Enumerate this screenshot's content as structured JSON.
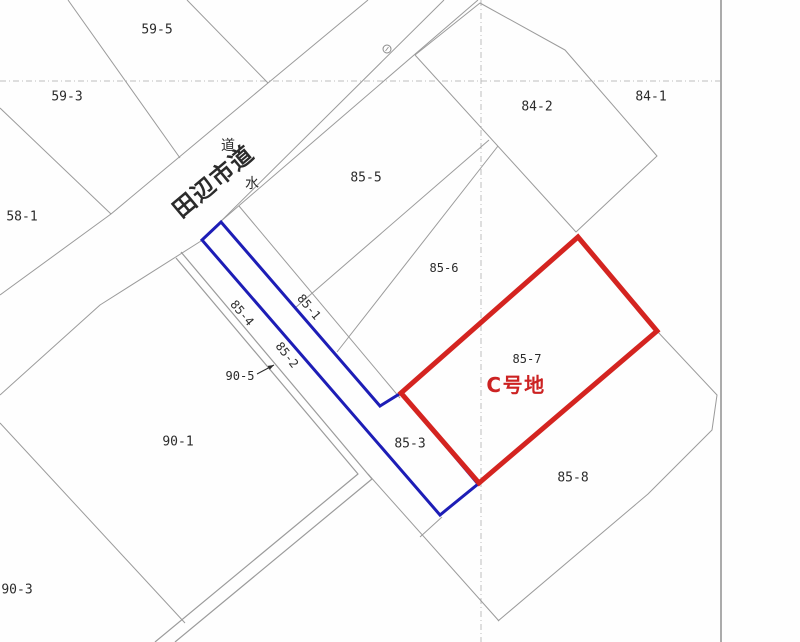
{
  "map": {
    "title_semantic": "cadastral-parcel-map",
    "width": 800,
    "height": 642,
    "colors": {
      "background": "#fefefe",
      "parcel_line": "#9b9b9b",
      "grid_dash_line": "#bdbdbd",
      "sheet_edge": "#ababab",
      "highlight_blue": "#1d1db6",
      "highlight_red": "#d42420",
      "label_text": "#2b2b2b",
      "red_label_text": "#cc2222",
      "symbol_gray": "#8a8a8a"
    },
    "grid_dash_lines": [
      {
        "name": "grid-line-horizontal",
        "pts": [
          [
            0,
            81
          ],
          [
            721,
            81
          ]
        ]
      },
      {
        "name": "grid-line-vertical",
        "pts": [
          [
            481,
            0
          ],
          [
            481,
            642
          ]
        ]
      }
    ],
    "sheet_edge_line": {
      "name": "sheet-edge",
      "pts": [
        [
          721,
          0
        ],
        [
          721,
          642
        ]
      ]
    },
    "parcel_lines": [
      {
        "name": "boundary-59-5-west",
        "pts": [
          [
            68,
            0
          ],
          [
            180,
            158
          ]
        ]
      },
      {
        "name": "boundary-59-5-east",
        "pts": [
          [
            187,
            0
          ],
          [
            268,
            83
          ]
        ]
      },
      {
        "name": "road-northwest-edge",
        "pts": [
          [
            368,
            0
          ],
          [
            268,
            83
          ],
          [
            111,
            214
          ],
          [
            0,
            295
          ]
        ]
      },
      {
        "name": "road-southeast-edge",
        "pts": [
          [
            444,
            0
          ],
          [
            201,
            241
          ],
          [
            100,
            305
          ],
          [
            0,
            395
          ]
        ]
      },
      {
        "name": "water-strip-east-edge",
        "pts": [
          [
            478,
            0
          ],
          [
            220,
            222
          ]
        ]
      },
      {
        "name": "boundary-59-3-southwest",
        "pts": [
          [
            0,
            108
          ],
          [
            111,
            214
          ]
        ]
      },
      {
        "name": "boundary-90-1-northwest",
        "pts": [
          [
            0,
            423
          ],
          [
            185,
            623
          ]
        ]
      },
      {
        "name": "parcel-84-2-outline",
        "pts": [
          [
            415,
            55
          ],
          [
            480,
            3
          ],
          [
            565,
            50
          ],
          [
            657,
            156
          ],
          [
            576,
            232
          ],
          [
            415,
            55
          ]
        ]
      },
      {
        "name": "boundary-85-5-85-6",
        "pts": [
          [
            489,
            140
          ],
          [
            295,
            308
          ]
        ]
      },
      {
        "name": "boundary-85-6-lower",
        "pts": [
          [
            498,
            146
          ],
          [
            337,
            352
          ]
        ]
      },
      {
        "name": "boundary-85-1-strip",
        "pts": [
          [
            239,
            206
          ],
          [
            400,
            398
          ]
        ]
      },
      {
        "name": "boundary-85-8-east",
        "pts": [
          [
            657,
            331
          ],
          [
            717,
            395
          ],
          [
            712,
            430
          ],
          [
            648,
            494
          ],
          [
            498,
            621
          ]
        ]
      },
      {
        "name": "boundary-85-8-northwest",
        "pts": [
          [
            368,
            474
          ],
          [
            499,
            621
          ]
        ]
      },
      {
        "name": "connector-85-3-tip",
        "pts": [
          [
            420,
            537
          ],
          [
            442,
            517
          ]
        ]
      }
    ],
    "channel_double_lines": [
      {
        "name": "channel-90-5-inner",
        "pts": [
          [
            176,
            258
          ],
          [
            358,
            474
          ],
          [
            155,
            642
          ]
        ]
      },
      {
        "name": "channel-90-5-outer",
        "pts": [
          [
            181,
            252
          ],
          [
            372,
            479
          ],
          [
            175,
            642
          ]
        ]
      }
    ],
    "highlight_blue_polygon": {
      "name": "highlight-parcel-85-1-strip",
      "pts": [
        [
          221,
          222
        ],
        [
          380,
          406
        ],
        [
          401,
          393
        ],
        [
          478,
          484
        ],
        [
          440,
          515
        ],
        [
          202,
          240
        ]
      ],
      "stroke_width": 3
    },
    "highlight_red_polygon": {
      "name": "highlight-parcel-85-7",
      "pts": [
        [
          578,
          237
        ],
        [
          657,
          331
        ],
        [
          479,
          483
        ],
        [
          401,
          393
        ]
      ],
      "stroke_width": 5
    },
    "survey_circle": {
      "name": "survey-point-symbol",
      "x": 387,
      "y": 49,
      "r": 4
    },
    "leader_arrow": {
      "name": "label-90-5-arrow",
      "from": [
        257,
        374
      ],
      "to": [
        274,
        365
      ]
    },
    "labels": [
      {
        "name": "parcel-label-59-5",
        "text": "59-5",
        "x": 157,
        "y": 30,
        "size": 13,
        "rot": 0,
        "kind": "num"
      },
      {
        "name": "parcel-label-59-3",
        "text": "59-3",
        "x": 67,
        "y": 97,
        "size": 13,
        "rot": 0,
        "kind": "num"
      },
      {
        "name": "parcel-label-58-1",
        "text": "58-1",
        "x": 22,
        "y": 217,
        "size": 13,
        "rot": 0,
        "kind": "num"
      },
      {
        "name": "parcel-label-84-2",
        "text": "84-2",
        "x": 537,
        "y": 107,
        "size": 13,
        "rot": 0,
        "kind": "num"
      },
      {
        "name": "parcel-label-84-1",
        "text": "84-1",
        "x": 651,
        "y": 97,
        "size": 13,
        "rot": 0,
        "kind": "num"
      },
      {
        "name": "parcel-label-85-5",
        "text": "85-5",
        "x": 366,
        "y": 178,
        "size": 13,
        "rot": 0,
        "kind": "num"
      },
      {
        "name": "parcel-label-85-6",
        "text": "85-6",
        "x": 444,
        "y": 268,
        "size": 12,
        "rot": 0,
        "kind": "num"
      },
      {
        "name": "parcel-label-85-7",
        "text": "85-7",
        "x": 527,
        "y": 359,
        "size": 12,
        "rot": 0,
        "kind": "num"
      },
      {
        "name": "parcel-label-85-8",
        "text": "85-8",
        "x": 573,
        "y": 478,
        "size": 13,
        "rot": 0,
        "kind": "num"
      },
      {
        "name": "parcel-label-85-3",
        "text": "85-3",
        "x": 410,
        "y": 444,
        "size": 13,
        "rot": 0,
        "kind": "num"
      },
      {
        "name": "parcel-label-90-1",
        "text": "90-1",
        "x": 178,
        "y": 442,
        "size": 13,
        "rot": 0,
        "kind": "num"
      },
      {
        "name": "parcel-label-90-3",
        "text": "90-3",
        "x": 17,
        "y": 590,
        "size": 13,
        "rot": 0,
        "kind": "num"
      },
      {
        "name": "parcel-label-90-5",
        "text": "90-5",
        "x": 240,
        "y": 376,
        "size": 12,
        "rot": 0,
        "kind": "num"
      },
      {
        "name": "parcel-label-85-1",
        "text": "85-1",
        "x": 309,
        "y": 307,
        "size": 12,
        "rot": 50,
        "kind": "num"
      },
      {
        "name": "parcel-label-85-4",
        "text": "85-4",
        "x": 242,
        "y": 313,
        "size": 12,
        "rot": 50,
        "kind": "num"
      },
      {
        "name": "parcel-label-85-2",
        "text": "85-2",
        "x": 287,
        "y": 355,
        "size": 12,
        "rot": 52,
        "kind": "num"
      },
      {
        "name": "road-strip-label",
        "text": "道",
        "x": 228,
        "y": 146,
        "size": 14,
        "rot": 0,
        "kind": "cjk"
      },
      {
        "name": "water-strip-label",
        "text": "水",
        "x": 252,
        "y": 184,
        "size": 14,
        "rot": 0,
        "kind": "cjk"
      },
      {
        "name": "road-name-label",
        "text": "田辺市道",
        "x": 214,
        "y": 182,
        "size": 23,
        "rot": -40,
        "kind": "cjk",
        "bold": true
      },
      {
        "name": "lot-c-label",
        "text": "C号地",
        "x": 516,
        "y": 385,
        "size": 20,
        "rot": 0,
        "kind": "cjk",
        "bold": true,
        "color_key": "red_label_text"
      }
    ]
  }
}
